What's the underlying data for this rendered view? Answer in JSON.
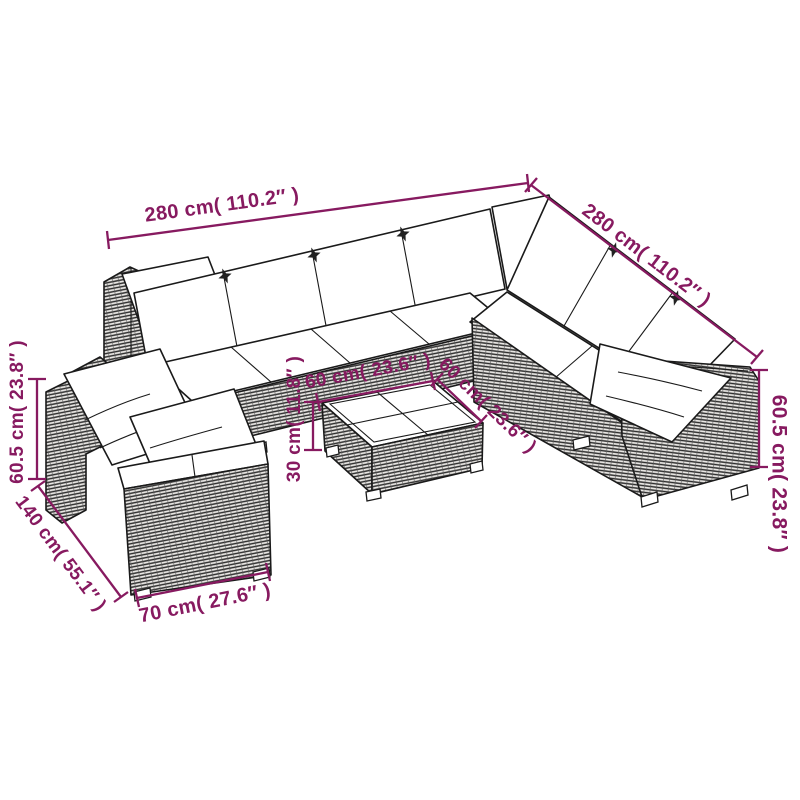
{
  "figure": {
    "type": "product-dimension-diagram",
    "alt": "Isometric line drawing of a poly rattan garden lounge set: L-shaped sectional sofa with white cushions, a separate corner sofa section and a square coffee table with four glass panes"
  },
  "colors": {
    "dimension_accent": "#871a60",
    "line_art": "#1a1a1a",
    "background": "#ffffff",
    "wicker_fill": "#e9e7e4"
  },
  "dimensions": {
    "sofa_top_width": {
      "cm": "280",
      "inches": "110.2",
      "label": "280 cm( 110.2″ )"
    },
    "sofa_right_width": {
      "cm": "280",
      "inches": "110.2",
      "label": "280 cm( 110.2″ )"
    },
    "sofa_height_right": {
      "cm": "60.5",
      "inches": "23.8",
      "label": "60.5 cm( 23.8″ )"
    },
    "sofa_height_left": {
      "cm": "60.5",
      "inches": "23.8",
      "label": "60.5 cm( 23.8″ )"
    },
    "corner_depth": {
      "cm": "140",
      "inches": "55.1",
      "label": "140 cm( 55.1″ )"
    },
    "module_width": {
      "cm": "70",
      "inches": "27.6",
      "label": "70 cm( 27.6″ )"
    },
    "table_width_left": {
      "cm": "60",
      "inches": "23.6",
      "label": "60 cm( 23.6″ )"
    },
    "table_width_right": {
      "cm": "60",
      "inches": "23.6",
      "label": "60 cm( 23.6″ )"
    },
    "table_height": {
      "cm": "30",
      "inches": "11.8",
      "label": "30 cm( 11.8″ )"
    }
  }
}
